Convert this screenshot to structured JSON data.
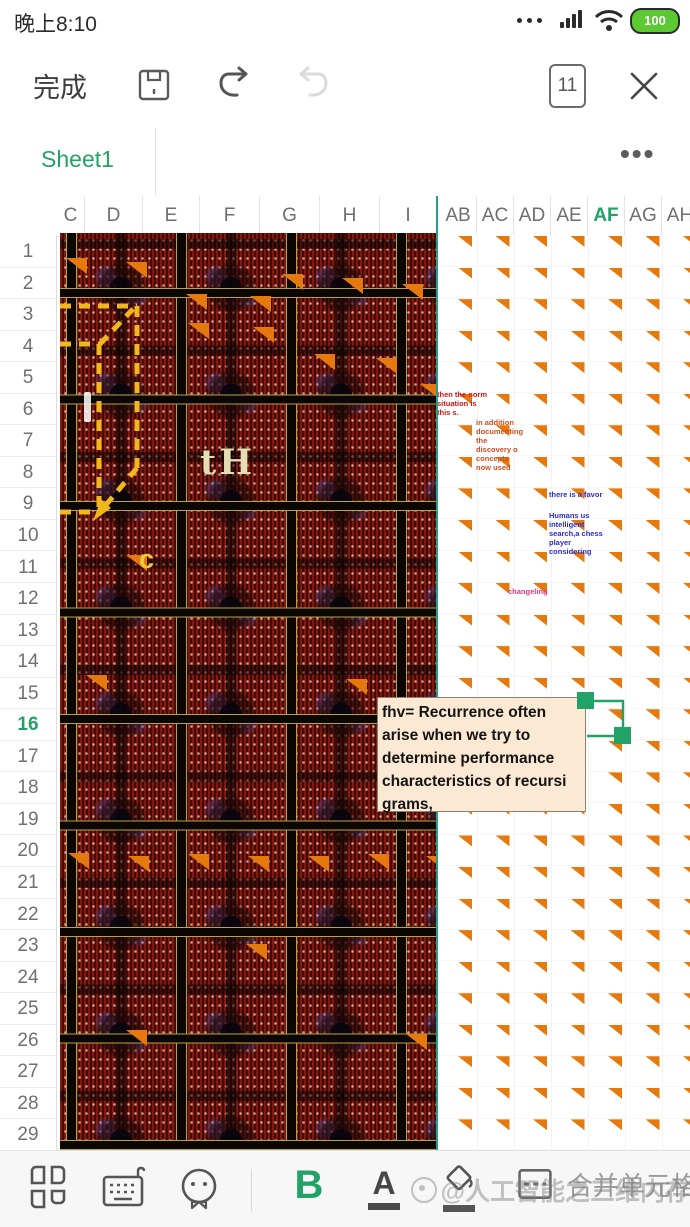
{
  "status_bar": {
    "time": "晚上8:10",
    "battery_level": "100"
  },
  "toolbar": {
    "done_label": "完成",
    "page_indicator": "11"
  },
  "sheet_tabs": {
    "active_tab": "Sheet1",
    "more": "•••"
  },
  "grid": {
    "columns": [
      "C",
      "D",
      "E",
      "F",
      "G",
      "H",
      "I",
      "AB",
      "AC",
      "AD",
      "AE",
      "AF",
      "AG",
      "AH"
    ],
    "active_column": "AF",
    "rows": [
      "1",
      "2",
      "3",
      "4",
      "5",
      "6",
      "7",
      "8",
      "9",
      "10",
      "11",
      "12",
      "13",
      "14",
      "15",
      "16",
      "17",
      "18",
      "19",
      "20",
      "21",
      "22",
      "23",
      "24",
      "25",
      "26",
      "27",
      "28",
      "29"
    ],
    "active_row": "16"
  },
  "chip_labels": {
    "label_th": "tH",
    "label_c": "c"
  },
  "notes": [
    {
      "text": "then the norm situation is this s.",
      "color": "#cc1515",
      "x": 437,
      "y": 390,
      "w": 50
    },
    {
      "text": "in addition documenting the discovery o concepts now used",
      "color": "#d34c1e",
      "x": 476,
      "y": 418,
      "w": 48
    },
    {
      "text": "there is a favor",
      "color": "#2b2bd0",
      "x": 549,
      "y": 490,
      "w": 54
    },
    {
      "text": "Humans us intelligent search,a chess player considering",
      "color": "#2b2bd0",
      "x": 549,
      "y": 511,
      "w": 54
    },
    {
      "text": "changeling",
      "color": "#d63a85",
      "x": 508,
      "y": 587,
      "w": 62
    }
  ],
  "comment": {
    "text": "fhv= Recurrence often arise when we try to determine performance characteristics of  recursi grams,"
  },
  "bottom_toolbar": {
    "bold_label": "B",
    "font_label": "A",
    "merge_label": "合并单元格"
  },
  "watermark": "@人工智能之三维内存",
  "colors": {
    "accent_green": "#21a266",
    "triangle_orange": "#e6790e",
    "dash_yellow": "#f2b71c",
    "comment_bg": "#fbe9d4"
  }
}
